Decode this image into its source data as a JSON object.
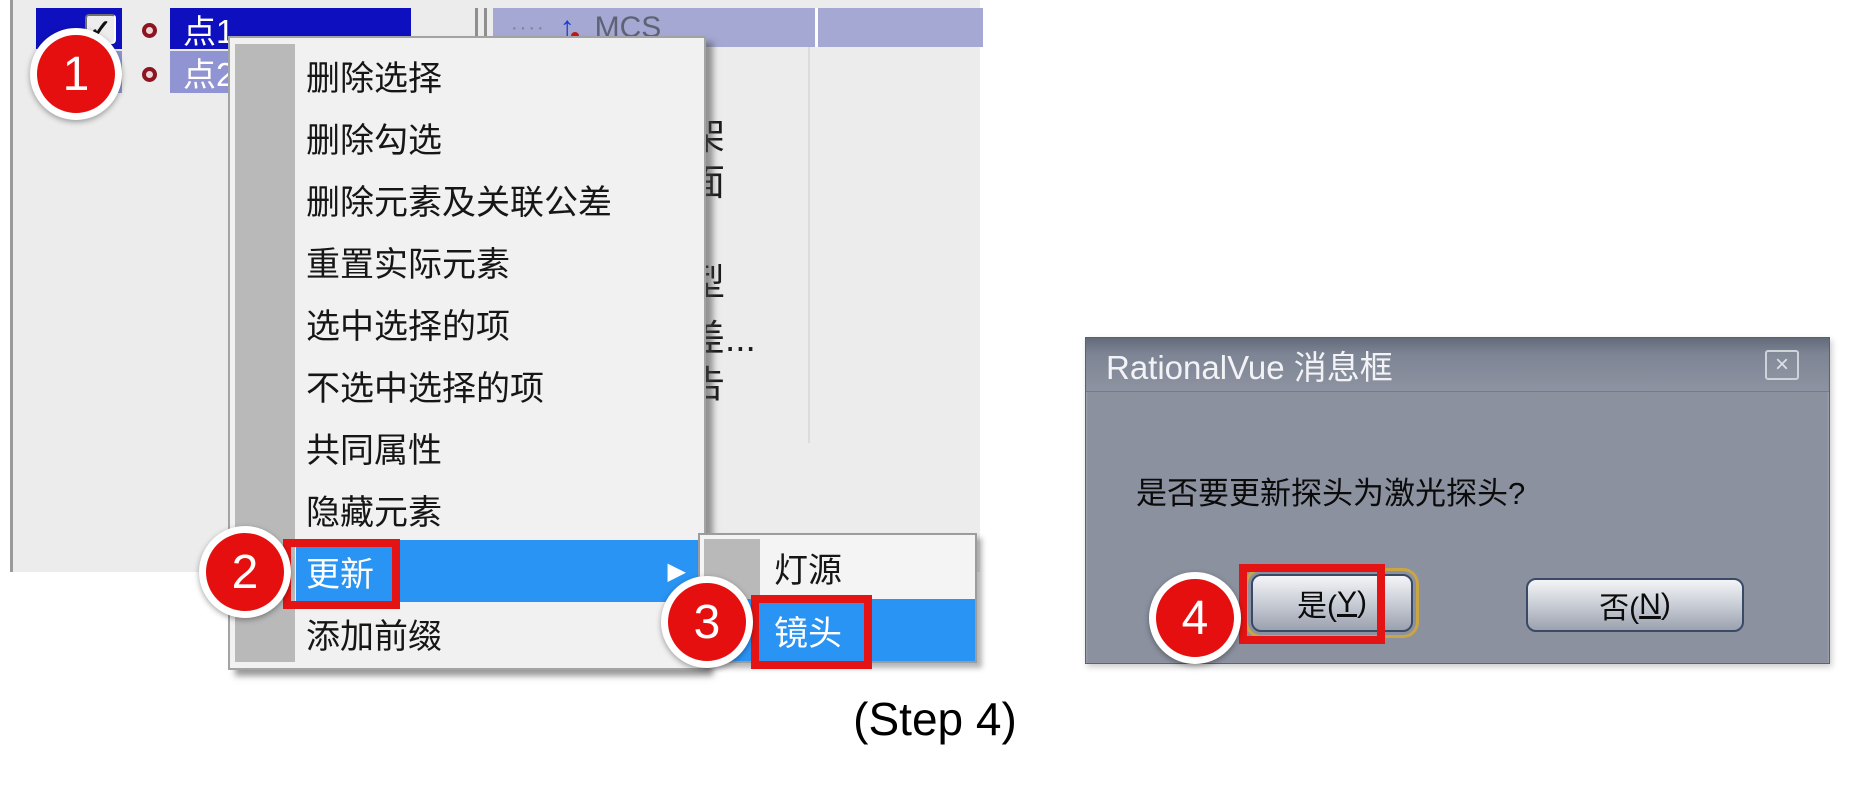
{
  "colors": {
    "highlight_blue": "#2a94f4",
    "selection_navy": "#0e10bf",
    "selection_lavender": "#9094d2",
    "header_lavender": "#a5a8d2",
    "annotation_red": "#e60f0f",
    "dialog_gray": "#8b919f"
  },
  "tree": {
    "rows": [
      {
        "label": "点1",
        "checked": true
      },
      {
        "label": "点2",
        "checked": true
      }
    ],
    "header": {
      "dots": "····",
      "arrow_glyph": "↑",
      "cs_label": "MCS"
    }
  },
  "background_fragments": {
    "f1": "架",
    "f2": "面",
    "f3": "型",
    "f4": "差...",
    "f5": "告"
  },
  "context_menu": {
    "items": [
      "删除选择",
      "删除勾选",
      "删除元素及关联公差",
      "重置实际元素",
      "选中选择的项",
      "不选中选择的项",
      "共同属性",
      "隐藏元素",
      "更新",
      "添加前缀"
    ],
    "highlighted_item": "更新",
    "submenu_arrow": "▶",
    "submenu": {
      "items": [
        "灯源",
        "镜头"
      ],
      "highlighted_item": "镜头"
    }
  },
  "dialog": {
    "title": "RationalVue 消息框",
    "close_icon": "×",
    "message": "是否要更新探头为激光探头?",
    "buttons": {
      "yes": {
        "pre": "是(",
        "key": "Y",
        "post": ")"
      },
      "no": {
        "pre": "否(",
        "key": "N",
        "post": ")"
      }
    }
  },
  "annotations": {
    "badge1": "1",
    "badge2": "2",
    "badge3": "3",
    "badge4": "4",
    "caption": "(Step 4)"
  },
  "checkmark": "✓"
}
